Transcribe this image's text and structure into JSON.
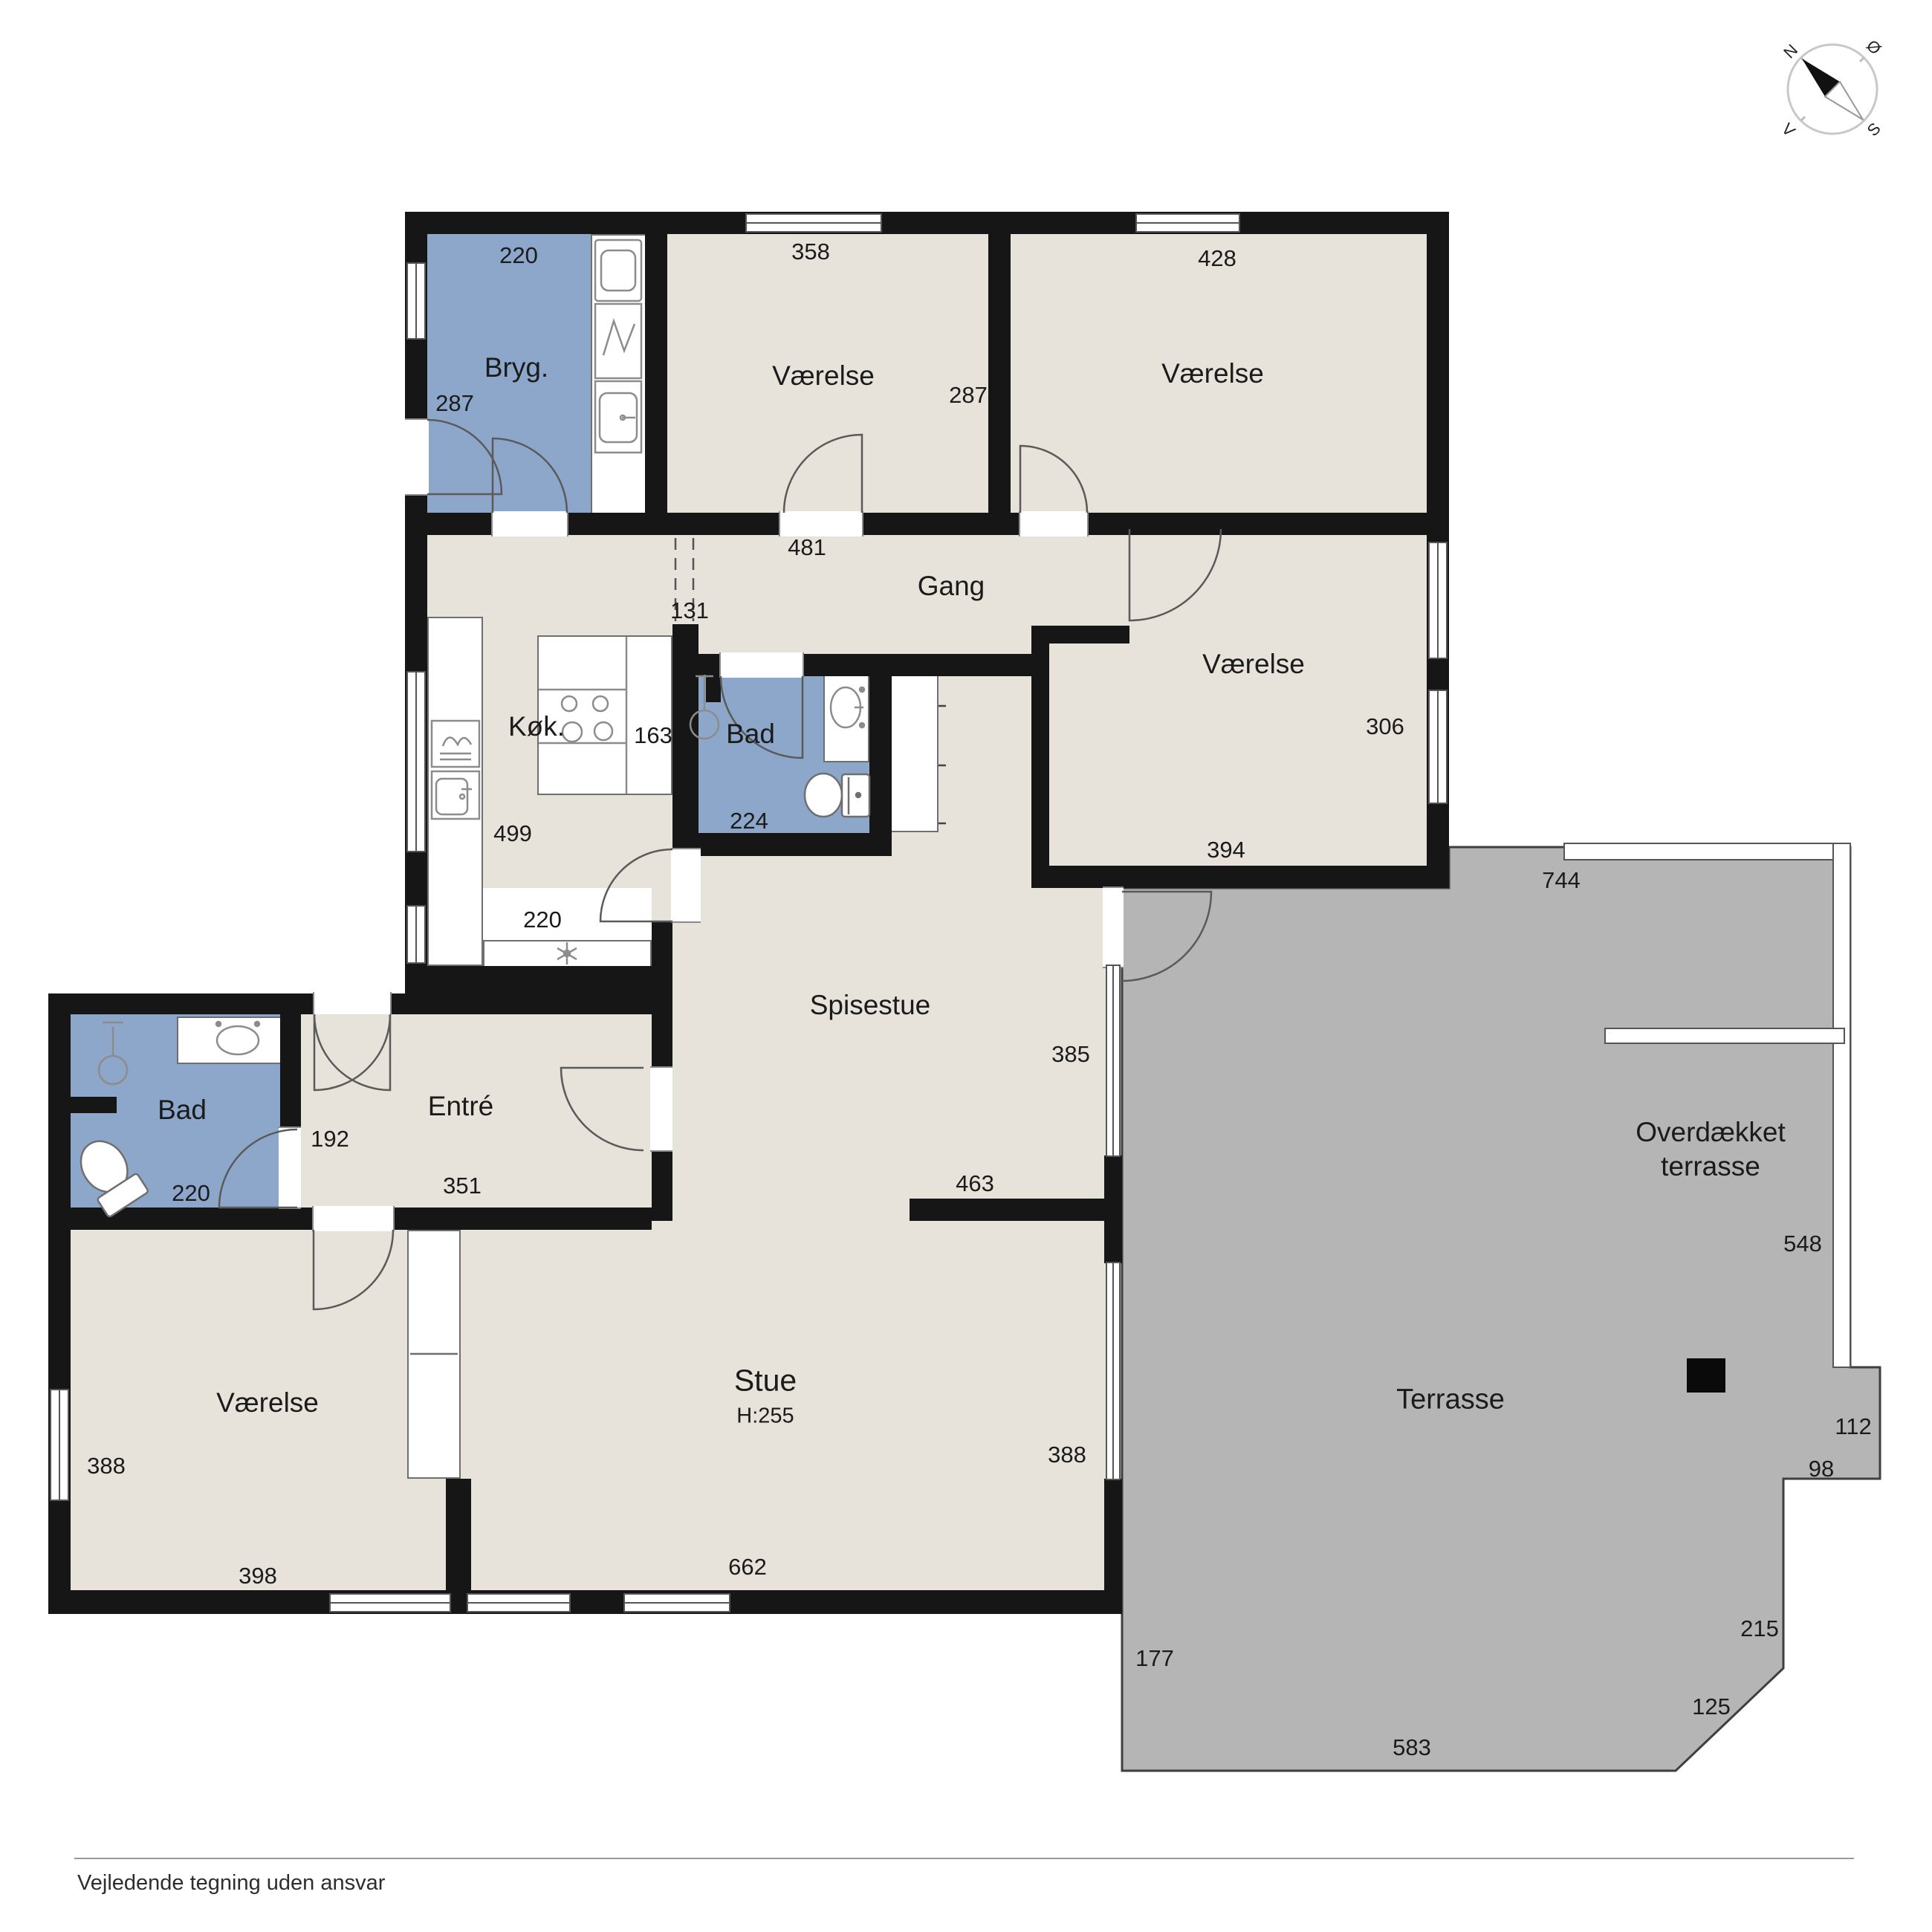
{
  "colors": {
    "room_fill": "#e7e3da",
    "wet_room_fill": "#8ca7c9",
    "terrace_fill": "#b5b5b5",
    "wall": "#161616"
  },
  "compass": {
    "n": "N",
    "e": "Ø",
    "s": "S",
    "w": "V"
  },
  "rooms": {
    "bryg": {
      "name": "Bryg.",
      "w": "220",
      "h": "287"
    },
    "room_nw": {
      "name": "Værelse",
      "w": "358",
      "h": "287"
    },
    "room_ne": {
      "name": "Værelse",
      "w": "428"
    },
    "gang": {
      "name": "Gang",
      "w": "481",
      "opening": "131"
    },
    "kok": {
      "name": "Køk.",
      "h": "499",
      "w": "220"
    },
    "bad_mid": {
      "name": "Bad",
      "nook": "163",
      "w": "224"
    },
    "room_e": {
      "name": "Værelse",
      "h": "306",
      "w": "394"
    },
    "spisestue": {
      "name": "Spisestue",
      "h": "385",
      "w": "463"
    },
    "entre": {
      "name": "Entré",
      "h": "192",
      "w": "351"
    },
    "bad_w": {
      "name": "Bad",
      "w": "220"
    },
    "room_sw": {
      "name": "Værelse",
      "h": "388",
      "w": "398"
    },
    "stue": {
      "name": "Stue",
      "ceiling": "H:255",
      "w": "662",
      "h": "388"
    },
    "overdaekket": {
      "line1": "Overdækket",
      "line2": "terrasse",
      "w": "744",
      "h": "548"
    },
    "terrasse": {
      "name": "Terrasse",
      "e1": "112",
      "e2": "98",
      "e3": "215",
      "e4": "125",
      "w": "583",
      "h": "177"
    }
  },
  "footer": {
    "disclaimer": "Vejledende tegning uden ansvar"
  }
}
